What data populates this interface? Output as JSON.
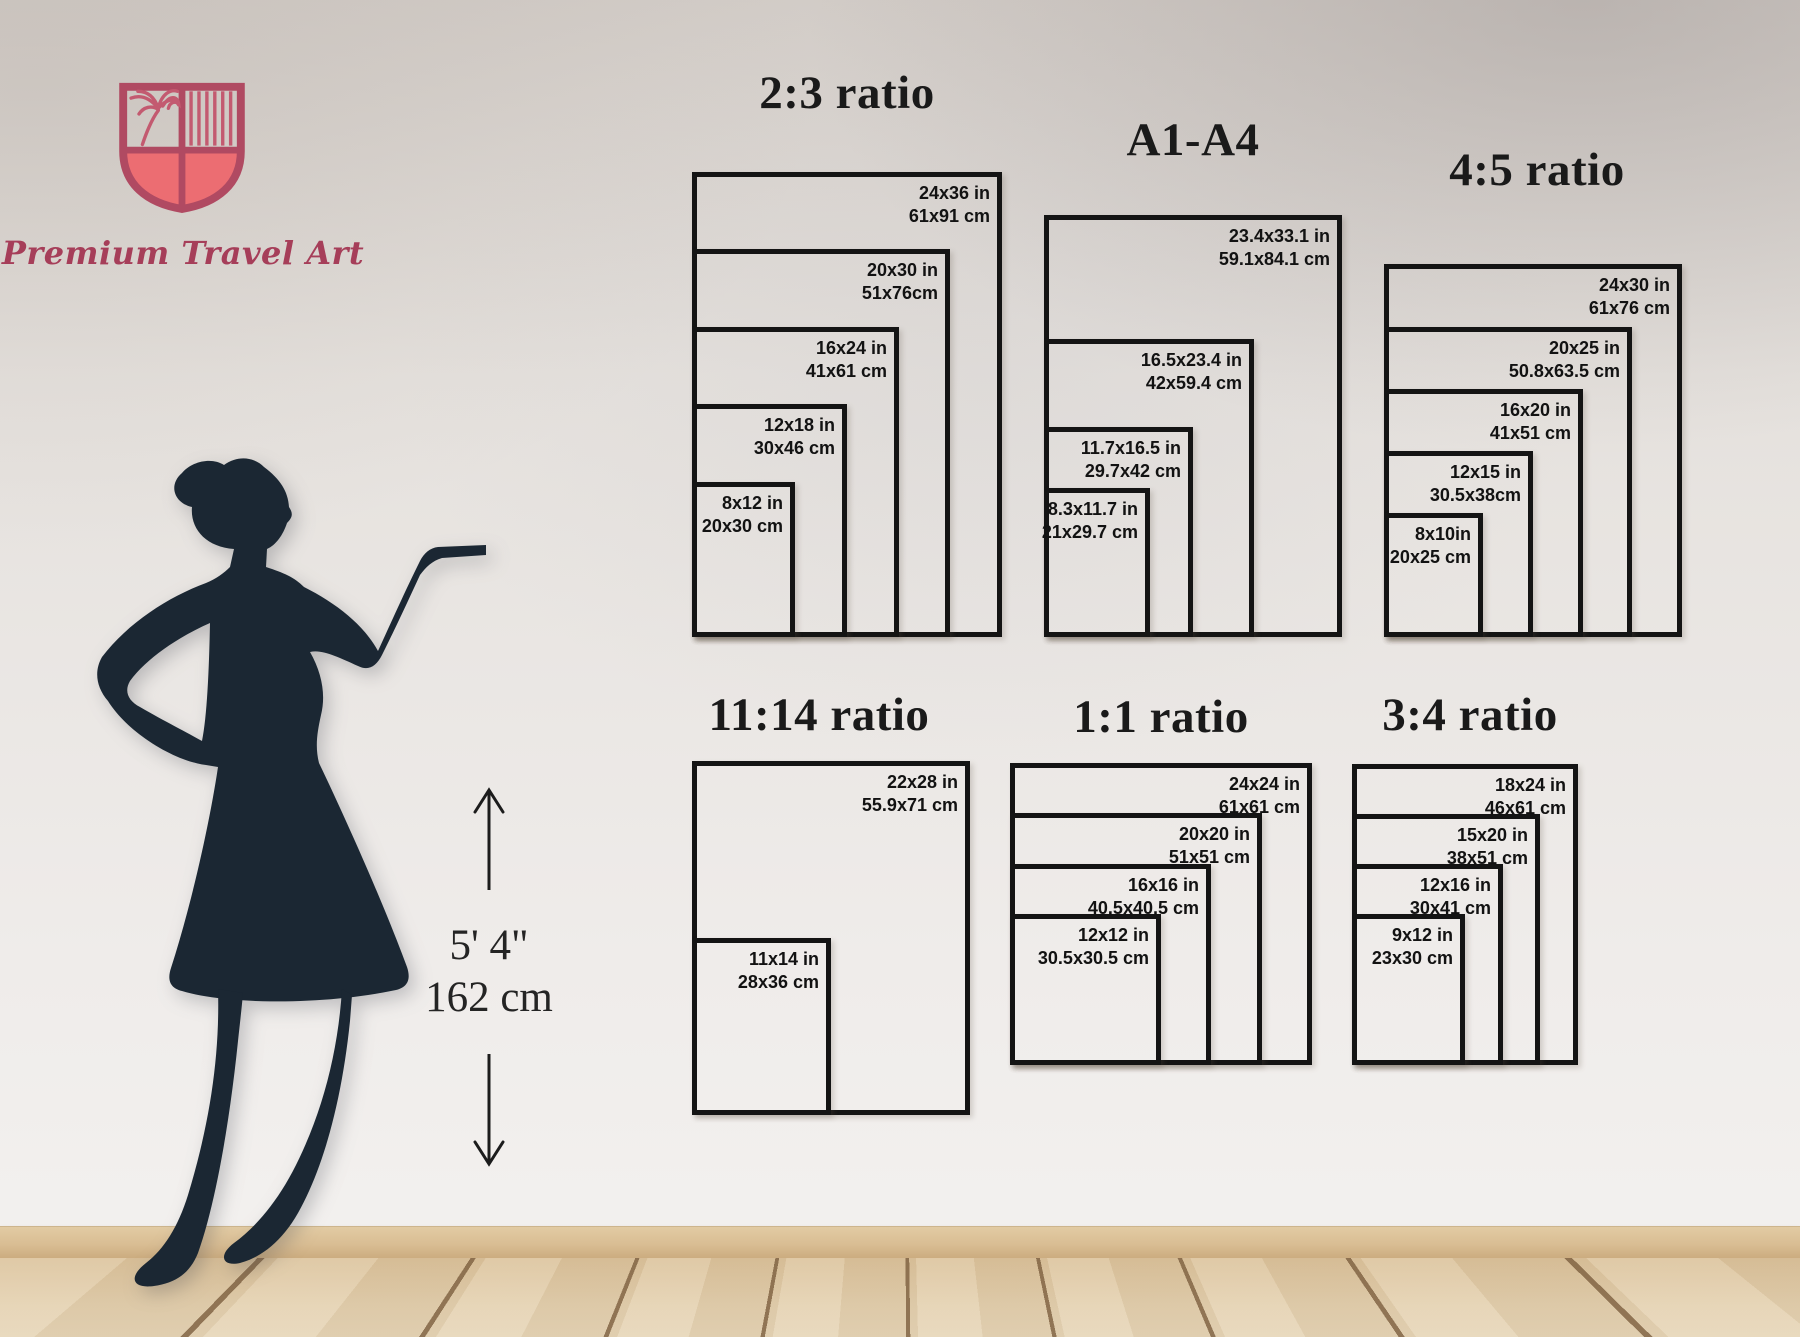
{
  "brand": {
    "name": "Premium Travel Art"
  },
  "reference_figure": {
    "figure": "woman-silhouette",
    "height_feet": "5' 4\"",
    "height_cm": "162 cm"
  },
  "colors": {
    "brand_accent": "#ec6d72",
    "brand_outline": "#b04a62",
    "brand_text": "#a63e59",
    "frame": "#141414",
    "silhouette": "#1b2733",
    "floor": "#dcc39c"
  },
  "icons": {
    "logo": "shield-crest-icon",
    "above_height": "arrow-up-icon",
    "below_height": "arrow-down-icon"
  },
  "groups": [
    {
      "id": "ratio-2-3",
      "title": "2:3 ratio",
      "sizes": [
        {
          "inches": "24x36 in",
          "cm": "61x91 cm",
          "w": 24,
          "h": 36
        },
        {
          "inches": "20x30 in",
          "cm": "51x76cm",
          "w": 20,
          "h": 30
        },
        {
          "inches": "16x24 in",
          "cm": "41x61 cm",
          "w": 16,
          "h": 24
        },
        {
          "inches": "12x18 in",
          "cm": "30x46 cm",
          "w": 12,
          "h": 18
        },
        {
          "inches": "8x12 in",
          "cm": "20x30 cm",
          "w": 8,
          "h": 12
        }
      ]
    },
    {
      "id": "a1-a4",
      "title": "A1-A4",
      "sizes": [
        {
          "inches": "23.4x33.1 in",
          "cm": "59.1x84.1 cm",
          "w": 23.4,
          "h": 33.1
        },
        {
          "inches": "16.5x23.4 in",
          "cm": "42x59.4 cm",
          "w": 16.5,
          "h": 23.4
        },
        {
          "inches": "11.7x16.5 in",
          "cm": "29.7x42 cm",
          "w": 11.7,
          "h": 16.5
        },
        {
          "inches": "8.3x11.7 in",
          "cm": "21x29.7 cm",
          "w": 8.3,
          "h": 11.7
        }
      ]
    },
    {
      "id": "ratio-4-5",
      "title": "4:5 ratio",
      "sizes": [
        {
          "inches": "24x30 in",
          "cm": "61x76 cm",
          "w": 24,
          "h": 30
        },
        {
          "inches": "20x25 in",
          "cm": "50.8x63.5 cm",
          "w": 20,
          "h": 25
        },
        {
          "inches": "16x20 in",
          "cm": "41x51 cm",
          "w": 16,
          "h": 20
        },
        {
          "inches": "12x15 in",
          "cm": "30.5x38cm",
          "w": 12,
          "h": 15
        },
        {
          "inches": "8x10in",
          "cm": "20x25 cm",
          "w": 8,
          "h": 10
        }
      ]
    },
    {
      "id": "ratio-11-14",
      "title": "11:14 ratio",
      "sizes": [
        {
          "inches": "22x28 in",
          "cm": "55.9x71 cm",
          "w": 22,
          "h": 28
        },
        {
          "inches": "11x14 in",
          "cm": "28x36 cm",
          "w": 11,
          "h": 14
        }
      ]
    },
    {
      "id": "ratio-1-1",
      "title": "1:1 ratio",
      "sizes": [
        {
          "inches": "24x24 in",
          "cm": "61x61 cm",
          "w": 24,
          "h": 24
        },
        {
          "inches": "20x20 in",
          "cm": "51x51 cm",
          "w": 20,
          "h": 20
        },
        {
          "inches": "16x16 in",
          "cm": "40.5x40.5 cm",
          "w": 16,
          "h": 16
        },
        {
          "inches": "12x12 in",
          "cm": "30.5x30.5 cm",
          "w": 12,
          "h": 12
        }
      ]
    },
    {
      "id": "ratio-3-4",
      "title": "3:4 ratio",
      "sizes": [
        {
          "inches": "18x24 in",
          "cm": "46x61 cm",
          "w": 18,
          "h": 24
        },
        {
          "inches": "15x20 in",
          "cm": "38x51 cm",
          "w": 15,
          "h": 20
        },
        {
          "inches": "12x16 in",
          "cm": "30x41 cm",
          "w": 12,
          "h": 16
        },
        {
          "inches": "9x12 in",
          "cm": "23x30 cm",
          "w": 9,
          "h": 12
        }
      ]
    }
  ]
}
